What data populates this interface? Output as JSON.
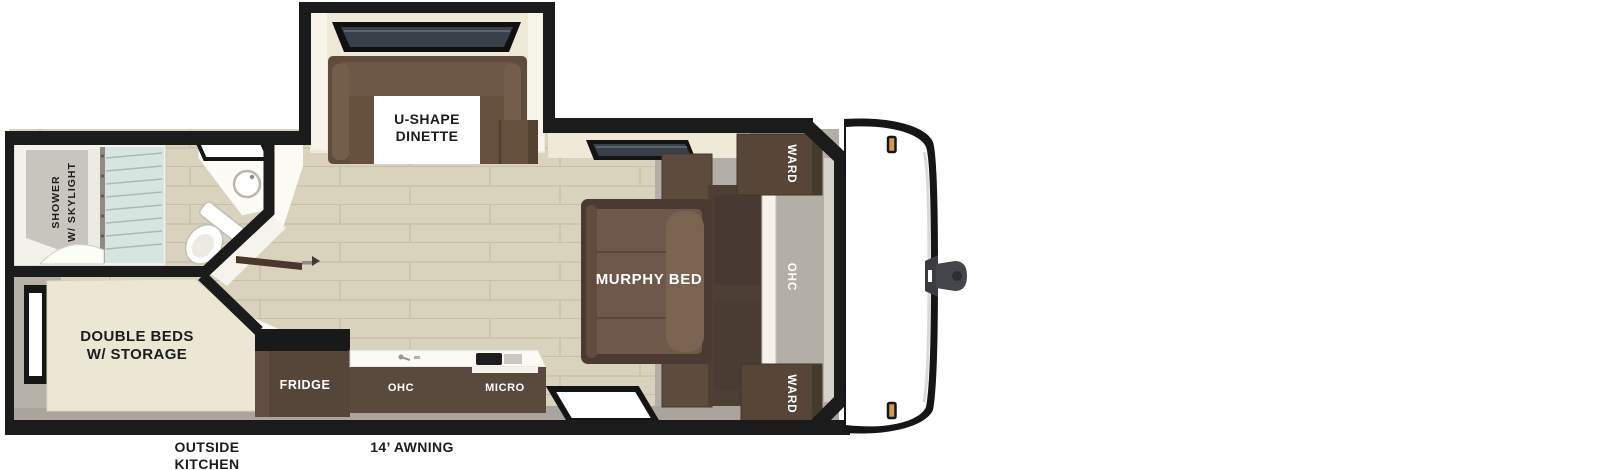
{
  "plan": {
    "labels": {
      "dinette_line1": "U-SHAPE",
      "dinette_line2": "DINETTE",
      "murphy_bed": "MURPHY BED",
      "ward_top": "WARD",
      "ward_bottom": "WARD",
      "ohc_front": "OHC",
      "fridge": "FRIDGE",
      "ohc_kitchen": "OHC",
      "micro": "MICRO",
      "shower_line1": "SHOWER",
      "shower_line2": "W/ SKYLIGHT",
      "beds_line1": "DOUBLE BEDS",
      "beds_line2": "W/ STORAGE",
      "outside_line1": "OUTSIDE",
      "outside_line2": "KITCHEN",
      "awning": "14’ AWNING"
    },
    "colors": {
      "wall": "#1b1b1b",
      "cabinet_dark": "#56463a",
      "cushion_brown": "#6e5849",
      "floor_wood": "#d9d2bc",
      "floor_line": "#c7bfa8",
      "carpet_gray": "#b3afa7",
      "walkway_gray": "#a9a59d",
      "wall_band_cream": "#efe9d7",
      "marker_light": "#d09a52",
      "glass_blue": "#d7e5e1",
      "text_dark": "#1c1c1c",
      "text_light": "#ffffff"
    }
  }
}
